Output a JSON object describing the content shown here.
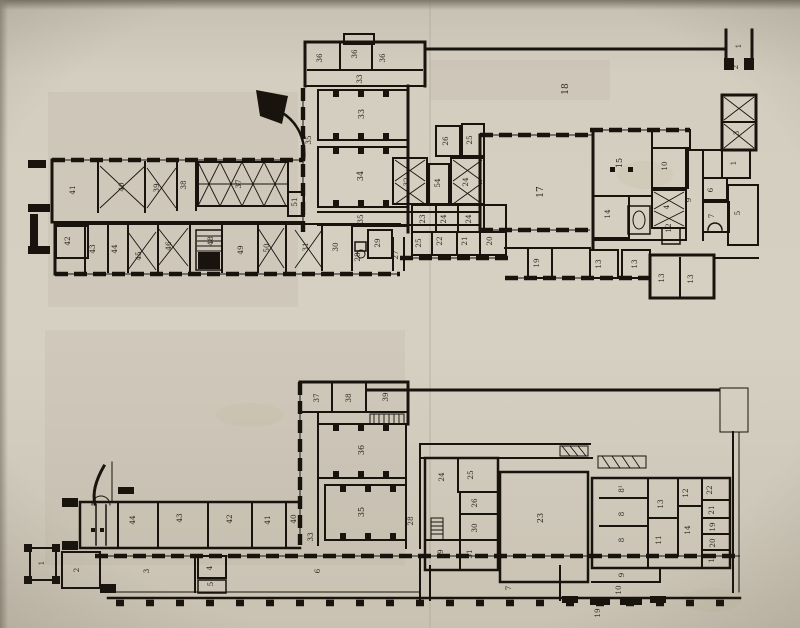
{
  "colors": {
    "ink": "#18130d",
    "paper": "#d2cbbd"
  },
  "plans": {
    "upper": {
      "labels": [
        {
          "t": "36",
          "x": 322,
          "y": 58
        },
        {
          "t": "36",
          "x": 357,
          "y": 54
        },
        {
          "t": "36",
          "x": 385,
          "y": 58
        },
        {
          "t": "33",
          "x": 362,
          "y": 79
        },
        {
          "t": "33",
          "x": 364,
          "y": 114,
          "s": 8
        },
        {
          "t": "35",
          "x": 311,
          "y": 140
        },
        {
          "t": "34",
          "x": 363,
          "y": 176,
          "s": 8
        },
        {
          "t": "51",
          "x": 297,
          "y": 202
        },
        {
          "t": "35",
          "x": 363,
          "y": 219
        },
        {
          "t": "41",
          "x": 75,
          "y": 190
        },
        {
          "t": "40",
          "x": 124,
          "y": 187
        },
        {
          "t": "39",
          "x": 159,
          "y": 188
        },
        {
          "t": "38",
          "x": 186,
          "y": 185
        },
        {
          "t": "37",
          "x": 241,
          "y": 184
        },
        {
          "t": "42",
          "x": 70,
          "y": 241
        },
        {
          "t": "43",
          "x": 95,
          "y": 249
        },
        {
          "t": "44",
          "x": 117,
          "y": 249
        },
        {
          "t": "45",
          "x": 141,
          "y": 256
        },
        {
          "t": "46",
          "x": 171,
          "y": 246
        },
        {
          "t": "48",
          "x": 213,
          "y": 241
        },
        {
          "t": "49",
          "x": 243,
          "y": 250
        },
        {
          "t": "50",
          "x": 269,
          "y": 248
        },
        {
          "t": "31",
          "x": 308,
          "y": 247
        },
        {
          "t": "30",
          "x": 338,
          "y": 247
        },
        {
          "t": "29",
          "x": 380,
          "y": 243
        },
        {
          "t": "28",
          "x": 360,
          "y": 257
        },
        {
          "t": "27",
          "x": 398,
          "y": 255
        },
        {
          "t": "26",
          "x": 448,
          "y": 141
        },
        {
          "t": "25",
          "x": 472,
          "y": 140
        },
        {
          "t": "32",
          "x": 409,
          "y": 182
        },
        {
          "t": "54",
          "x": 440,
          "y": 183
        },
        {
          "t": "24",
          "x": 468,
          "y": 182
        },
        {
          "t": "23",
          "x": 425,
          "y": 219
        },
        {
          "t": "24",
          "x": 446,
          "y": 219
        },
        {
          "t": "24",
          "x": 471,
          "y": 219
        },
        {
          "t": "25",
          "x": 421,
          "y": 243
        },
        {
          "t": "22",
          "x": 442,
          "y": 241
        },
        {
          "t": "21",
          "x": 467,
          "y": 241
        },
        {
          "t": "20",
          "x": 492,
          "y": 241
        },
        {
          "t": "18",
          "x": 568,
          "y": 89,
          "s": 9
        },
        {
          "t": "17",
          "x": 543,
          "y": 192,
          "s": 9
        },
        {
          "t": "15",
          "x": 622,
          "y": 163,
          "s": 8
        },
        {
          "t": "10",
          "x": 667,
          "y": 166
        },
        {
          "t": "14",
          "x": 610,
          "y": 214
        },
        {
          "t": "4",
          "x": 669,
          "y": 207
        },
        {
          "t": "12",
          "x": 671,
          "y": 228
        },
        {
          "t": "9",
          "x": 691,
          "y": 200
        },
        {
          "t": "6",
          "x": 713,
          "y": 190
        },
        {
          "t": "7",
          "x": 714,
          "y": 216
        },
        {
          "t": "5",
          "x": 740,
          "y": 213
        },
        {
          "t": "1",
          "x": 736,
          "y": 163
        },
        {
          "t": "3",
          "x": 739,
          "y": 133
        },
        {
          "t": "2",
          "x": 738,
          "y": 67
        },
        {
          "t": "1",
          "x": 741,
          "y": 46
        },
        {
          "t": "19",
          "x": 539,
          "y": 263
        },
        {
          "t": "13",
          "x": 601,
          "y": 264
        },
        {
          "t": "13",
          "x": 637,
          "y": 264
        },
        {
          "t": "13",
          "x": 664,
          "y": 278
        },
        {
          "t": "13",
          "x": 693,
          "y": 279
        }
      ]
    },
    "lower": {
      "labels": [
        {
          "t": "37",
          "x": 319,
          "y": 398
        },
        {
          "t": "38",
          "x": 351,
          "y": 398
        },
        {
          "t": "39",
          "x": 388,
          "y": 397
        },
        {
          "t": "36",
          "x": 364,
          "y": 450,
          "s": 8
        },
        {
          "t": "35",
          "x": 364,
          "y": 512,
          "s": 8
        },
        {
          "t": "28",
          "x": 413,
          "y": 521
        },
        {
          "t": "33",
          "x": 313,
          "y": 537
        },
        {
          "t": "44",
          "x": 135,
          "y": 520
        },
        {
          "t": "43",
          "x": 182,
          "y": 518
        },
        {
          "t": "42",
          "x": 232,
          "y": 519
        },
        {
          "t": "41",
          "x": 270,
          "y": 520
        },
        {
          "t": "40",
          "x": 296,
          "y": 519
        },
        {
          "t": "24",
          "x": 444,
          "y": 477
        },
        {
          "t": "25",
          "x": 473,
          "y": 475
        },
        {
          "t": "26",
          "x": 477,
          "y": 503
        },
        {
          "t": "30",
          "x": 477,
          "y": 528
        },
        {
          "t": "29",
          "x": 443,
          "y": 554
        },
        {
          "t": "31",
          "x": 472,
          "y": 554
        },
        {
          "t": "23",
          "x": 543,
          "y": 518,
          "s": 8
        },
        {
          "t": "8¹",
          "x": 624,
          "y": 489
        },
        {
          "t": "8",
          "x": 624,
          "y": 514
        },
        {
          "t": "8",
          "x": 624,
          "y": 540
        },
        {
          "t": "13",
          "x": 663,
          "y": 504
        },
        {
          "t": "11",
          "x": 661,
          "y": 540
        },
        {
          "t": "12",
          "x": 688,
          "y": 493
        },
        {
          "t": "14",
          "x": 690,
          "y": 530
        },
        {
          "t": "22",
          "x": 712,
          "y": 490
        },
        {
          "t": "21",
          "x": 714,
          "y": 510
        },
        {
          "t": "19",
          "x": 715,
          "y": 527
        },
        {
          "t": "20",
          "x": 715,
          "y": 543
        },
        {
          "t": "18",
          "x": 714,
          "y": 558
        },
        {
          "t": "9",
          "x": 624,
          "y": 575
        },
        {
          "t": "10",
          "x": 621,
          "y": 590
        },
        {
          "t": "19",
          "x": 600,
          "y": 613
        },
        {
          "t": "1",
          "x": 44,
          "y": 563
        },
        {
          "t": "2",
          "x": 79,
          "y": 570
        },
        {
          "t": "3",
          "x": 149,
          "y": 571
        },
        {
          "t": "4",
          "x": 212,
          "y": 568
        },
        {
          "t": "5",
          "x": 213,
          "y": 584
        },
        {
          "t": "6",
          "x": 320,
          "y": 571
        },
        {
          "t": "7",
          "x": 511,
          "y": 588
        }
      ]
    }
  }
}
